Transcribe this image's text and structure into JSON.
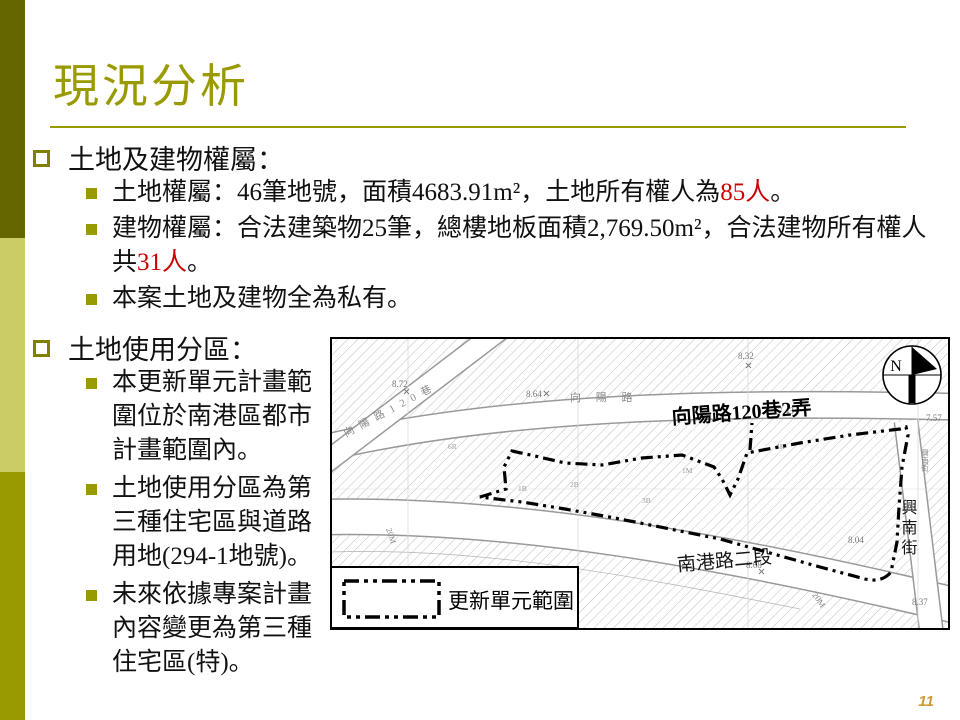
{
  "slide": {
    "title": "現況分析",
    "page_number": "11"
  },
  "palette": {
    "accent": "#999900",
    "sidebar_dark": "#666600",
    "sidebar_light": "#cccc66",
    "highlight_red": "#cc0000",
    "page_number_color": "#cc9933"
  },
  "sections": [
    {
      "heading": "土地及建物權屬：",
      "items": [
        {
          "parts": [
            {
              "text": "土地權屬：46筆地號，面積4683.91m²，土地所有權人為"
            },
            {
              "text": "85人",
              "highlight": true
            },
            {
              "text": "。"
            }
          ]
        },
        {
          "parts": [
            {
              "text": "建物權屬：合法建築物25筆，總樓地板面積2,769.50m²，合法建物所有權人共"
            },
            {
              "text": "31人",
              "highlight": true
            },
            {
              "text": "。"
            }
          ]
        },
        {
          "parts": [
            {
              "text": "本案土地及建物全為私有。"
            }
          ]
        }
      ]
    },
    {
      "heading": "土地使用分區：",
      "items": [
        {
          "parts": [
            {
              "text": "本更新單元計畫範圍位於南港區都市計畫範圍內。"
            }
          ]
        },
        {
          "parts": [
            {
              "text": "土地使用分區為第三種住宅區與道路用地(294-1地號)。"
            }
          ]
        },
        {
          "parts": [
            {
              "text": "未來依據專案計畫內容變更為第三種住宅區(特)。"
            }
          ]
        }
      ]
    }
  ],
  "map": {
    "legend_label": "更新單元範圍",
    "compass_label": "N",
    "road_labels": [
      "向陽路120巷2弄",
      "南港路二段",
      "興南街",
      "向 陽 路 1 2 0 巷",
      "向 陽 路",
      "興南街"
    ],
    "spot_elevations": [
      "8.72",
      "8.64",
      "8.32",
      "7.43",
      "7.57",
      "8.04",
      "8.68",
      "8.37"
    ],
    "scale_labels": [
      "20M",
      "20M"
    ],
    "parcel_labels": [
      "4R",
      "1M",
      "2B",
      "1B",
      "3B",
      "6R"
    ]
  }
}
